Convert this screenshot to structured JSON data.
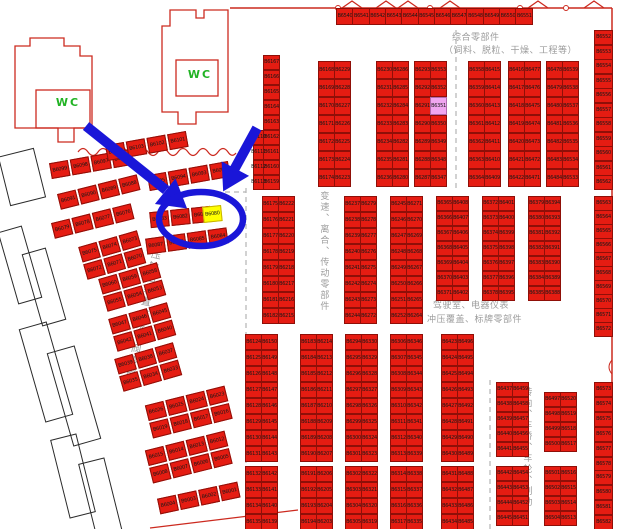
{
  "map": {
    "wc1": "WC",
    "wc2": "WC",
    "zones": {
      "comprehensive_line1": "综合零部件",
      "comprehensive_line2": "（饲料、脱粒、干燥、工程等）",
      "transmission": "变速、离合、传动零部件",
      "cab_line1": "驾驶室、电器仪表",
      "cab_line2": "冲压覆盖、标牌零部件",
      "steering": "转向、车桥、车轮、制动",
      "hydraulic": "液压输出装置、泵、阀零部件"
    },
    "highlight": {
      "selected_cell": "B6080",
      "selected_color": "#ffff00",
      "secondary_cell": "B6351",
      "secondary_color": "#f0a6f0"
    },
    "colors": {
      "cell_red": "#e51c12",
      "wall_red": "#cc2a1f",
      "annotation_blue": "#1a16d8",
      "wc_green": "#21b324",
      "zone_gray": "#9c9c9c"
    },
    "top_row": {
      "x": 336,
      "y": 8,
      "cw": 16,
      "ch": 15,
      "pitch": 16.3,
      "cells": [
        "B6540",
        "B6541",
        "B6542",
        "B6543",
        "B6544",
        "B6545",
        "B6546",
        "B6547",
        "B6548",
        "B6549",
        "B6550",
        "B6551"
      ]
    },
    "racks": [
      {
        "x": 263,
        "y": 55,
        "pitch": 15,
        "cw": 15,
        "ch": 13,
        "cols": [
          [
            "B6167",
            "B6166",
            "B6165",
            "B6164",
            "B6163",
            "B6162",
            "B6161",
            "B6160",
            "B6159"
          ]
        ]
      },
      {
        "x": 253,
        "y": 130,
        "pitch": 15,
        "cw": 9,
        "ch": 13,
        "cols": [
          [
            "B6110",
            "B6111",
            "B6112",
            "B6113"
          ]
        ]
      },
      {
        "x": 318,
        "y": 61,
        "pitch": 18,
        "cw": 15,
        "ch": 16,
        "cols": [
          [
            "B6168",
            "B6169",
            "B6170",
            "B6171",
            "B6172",
            "B6173",
            "B6174"
          ],
          [
            "B6229",
            "B6228",
            "B6227",
            "B6226",
            "B6225",
            "B6224",
            "B6223"
          ]
        ]
      },
      {
        "x": 376,
        "y": 61,
        "pitch": 18,
        "cw": 15,
        "ch": 16,
        "cols": [
          [
            "B6230",
            "B6231",
            "B6232",
            "B6233",
            "B6234",
            "B6235",
            "B6236"
          ],
          [
            "B6286",
            "B6285",
            "B6284",
            "B6283",
            "B6282",
            "B6281",
            "B6280"
          ]
        ]
      },
      {
        "x": 414,
        "y": 61,
        "pitch": 18,
        "cw": 15,
        "ch": 16,
        "cols": [
          [
            "B6293",
            "B6292",
            "B6291",
            "B6290",
            "B6289",
            "B6288",
            "B6287"
          ],
          [
            "B6353",
            "B6352",
            "B6351",
            "B6350",
            "B6349",
            "B6348",
            "B6347"
          ]
        ]
      },
      {
        "x": 468,
        "y": 61,
        "pitch": 18,
        "cw": 15,
        "ch": 16,
        "cols": [
          [
            "B6358",
            "B6359",
            "B6360",
            "B6361",
            "B6362",
            "B6363",
            "B6364"
          ],
          [
            "B6415",
            "B6414",
            "B6413",
            "B6412",
            "B6411",
            "B6410",
            "B6409"
          ]
        ]
      },
      {
        "x": 508,
        "y": 61,
        "pitch": 18,
        "cw": 15,
        "ch": 16,
        "cols": [
          [
            "B6416",
            "B6417",
            "B6418",
            "B6419",
            "B6420",
            "B6421",
            "B6422"
          ],
          [
            "B6477",
            "B6476",
            "B6475",
            "B6474",
            "B6473",
            "B6472",
            "B6471"
          ]
        ]
      },
      {
        "x": 546,
        "y": 61,
        "pitch": 18,
        "cw": 15,
        "ch": 16,
        "cols": [
          [
            "B6478",
            "B6479",
            "B6480",
            "B6481",
            "B6482",
            "B6483",
            "B6484"
          ],
          [
            "B6539",
            "B6538",
            "B6537",
            "B6536",
            "B6535",
            "B6534",
            "B6533"
          ]
        ]
      },
      {
        "x": 594,
        "y": 30,
        "pitch": 14.5,
        "cw": 17,
        "ch": 13,
        "cols": [
          [
            "B6552",
            "B6553",
            "B6554",
            "B6555",
            "B6556",
            "B6557",
            "B6558",
            "B6559",
            "B6560",
            "B6561",
            "B6562"
          ]
        ]
      },
      {
        "x": 262,
        "y": 196,
        "pitch": 16,
        "cw": 15,
        "ch": 14,
        "cols": [
          [
            "B6175",
            "B6176",
            "B6177",
            "B6178",
            "B6179",
            "B6180",
            "B6181",
            "B6182"
          ],
          [
            "B6222",
            "B6221",
            "B6220",
            "B6219",
            "B6218",
            "B6217",
            "B6216",
            "B6215"
          ]
        ]
      },
      {
        "x": 344,
        "y": 196,
        "pitch": 16,
        "cw": 15,
        "ch": 14,
        "cols": [
          [
            "B6237",
            "B6238",
            "B6239",
            "B6240",
            "B6241",
            "B6242",
            "B6243",
            "B6244"
          ],
          [
            "B6279",
            "B6278",
            "B6277",
            "B6276",
            "B6275",
            "B6274",
            "B6273",
            "B6272"
          ]
        ]
      },
      {
        "x": 390,
        "y": 196,
        "pitch": 16,
        "cw": 15,
        "ch": 14,
        "cols": [
          [
            "B6245",
            "B6246",
            "B6247",
            "B6248",
            "B6249",
            "B6250",
            "B6251",
            "B6252"
          ],
          [
            "B6271",
            "B6270",
            "B6269",
            "B6268",
            "B6267",
            "B6266",
            "B6265",
            "B6264"
          ]
        ]
      },
      {
        "x": 436,
        "y": 196,
        "pitch": 15,
        "cw": 15,
        "ch": 13,
        "cols": [
          [
            "B6365",
            "B6366",
            "B6367",
            "B6368",
            "B6369",
            "B6370",
            "B6371"
          ],
          [
            "B6408",
            "B6407",
            "B6406",
            "B6405",
            "B6404",
            "B6403",
            "B6402"
          ]
        ]
      },
      {
        "x": 482,
        "y": 196,
        "pitch": 15,
        "cw": 15,
        "ch": 13,
        "cols": [
          [
            "B6372",
            "B6373",
            "B6374",
            "B6375",
            "B6376",
            "B6377",
            "B6378"
          ],
          [
            "B6401",
            "B6400",
            "B6399",
            "B6398",
            "B6397",
            "B6396",
            "B6395"
          ]
        ]
      },
      {
        "x": 528,
        "y": 196,
        "pitch": 15,
        "cw": 15,
        "ch": 13,
        "cols": [
          [
            "B6379",
            "B6380",
            "B6381",
            "B6382",
            "B6383",
            "B6384",
            "B6385"
          ],
          [
            "B6394",
            "B6393",
            "B6392",
            "B6391",
            "B6390",
            "B6389",
            "B6388"
          ]
        ]
      },
      {
        "x": 594,
        "y": 196,
        "pitch": 14,
        "cw": 17,
        "ch": 13,
        "cols": [
          [
            "B6563",
            "B6564",
            "B6565",
            "B6566",
            "B6567",
            "B6568",
            "B6569",
            "B6570",
            "B6571",
            "B6572"
          ]
        ]
      },
      {
        "x": 245,
        "y": 334,
        "pitch": 16,
        "cw": 15,
        "ch": 14,
        "cols": [
          [
            "B6124",
            "B6125",
            "B6126",
            "B6127",
            "B6128",
            "B6129",
            "B6130",
            "B6131"
          ],
          [
            "B6150",
            "B6149",
            "B6148",
            "B6147",
            "B6146",
            "B6145",
            "B6144",
            "B6143"
          ]
        ]
      },
      {
        "x": 245,
        "y": 466,
        "pitch": 16,
        "cw": 15,
        "ch": 14,
        "cols": [
          [
            "B6132",
            "B6133",
            "B6134",
            "B6135"
          ],
          [
            "B6142",
            "B6141",
            "B6140",
            "B6139"
          ]
        ]
      },
      {
        "x": 300,
        "y": 334,
        "pitch": 16,
        "cw": 15,
        "ch": 14,
        "cols": [
          [
            "B6183",
            "B6184",
            "B6185",
            "B6186",
            "B6187",
            "B6188",
            "B6189",
            "B6190"
          ],
          [
            "B6214",
            "B6213",
            "B6212",
            "B6211",
            "B6210",
            "B6209",
            "B6208",
            "B6207"
          ]
        ]
      },
      {
        "x": 300,
        "y": 466,
        "pitch": 16,
        "cw": 15,
        "ch": 14,
        "cols": [
          [
            "B6191",
            "B6192",
            "B6193",
            "B6194"
          ],
          [
            "B6206",
            "B6205",
            "B6204",
            "B6203"
          ]
        ]
      },
      {
        "x": 345,
        "y": 334,
        "pitch": 16,
        "cw": 15,
        "ch": 14,
        "cols": [
          [
            "B6294",
            "B6295",
            "B6296",
            "B6297",
            "B6298",
            "B6299",
            "B6300",
            "B6301"
          ],
          [
            "B6330",
            "B6329",
            "B6328",
            "B6327",
            "B6326",
            "B6325",
            "B6324",
            "B6323"
          ]
        ]
      },
      {
        "x": 345,
        "y": 466,
        "pitch": 16,
        "cw": 15,
        "ch": 14,
        "cols": [
          [
            "B6302",
            "B6303",
            "B6304",
            "B6305"
          ],
          [
            "B6322",
            "B6321",
            "B6320",
            "B6319"
          ]
        ]
      },
      {
        "x": 390,
        "y": 334,
        "pitch": 16,
        "cw": 15,
        "ch": 14,
        "cols": [
          [
            "B6306",
            "B6307",
            "B6308",
            "B6309",
            "B6310",
            "B6311",
            "B6312",
            "B6313"
          ],
          [
            "B6346",
            "B6345",
            "B6344",
            "B6343",
            "B6342",
            "B6341",
            "B6340",
            "B6339"
          ]
        ]
      },
      {
        "x": 390,
        "y": 466,
        "pitch": 16,
        "cw": 15,
        "ch": 14,
        "cols": [
          [
            "B6314",
            "B6315",
            "B6316",
            "B6317"
          ],
          [
            "B6338",
            "B6337",
            "B6336",
            "B6335"
          ]
        ]
      },
      {
        "x": 441,
        "y": 334,
        "pitch": 16,
        "cw": 15,
        "ch": 14,
        "cols": [
          [
            "B6423",
            "B6424",
            "B6425",
            "B6426",
            "B6427",
            "B6428",
            "B6429",
            "B6430"
          ],
          [
            "B6496",
            "B6495",
            "B6494",
            "B6493",
            "B6492",
            "B6491",
            "B6490",
            "B6489"
          ]
        ]
      },
      {
        "x": 441,
        "y": 466,
        "pitch": 16,
        "cw": 15,
        "ch": 14,
        "cols": [
          [
            "B6431",
            "B6432",
            "B6433",
            "B6434"
          ],
          [
            "B6488",
            "B6487",
            "B6486",
            "B6485"
          ]
        ]
      },
      {
        "x": 496,
        "y": 382,
        "pitch": 15,
        "cw": 15,
        "ch": 13,
        "cols": [
          [
            "B6437",
            "B6438",
            "B6439",
            "B6440",
            "B6441"
          ],
          [
            "B6459",
            "B6458",
            "B6457",
            "B6456",
            "B6455"
          ]
        ]
      },
      {
        "x": 496,
        "y": 466,
        "pitch": 15,
        "cw": 15,
        "ch": 13,
        "cols": [
          [
            "B6442",
            "B6443",
            "B6444",
            "B6445"
          ],
          [
            "B6454",
            "B6453",
            "B6452",
            "B6451"
          ]
        ]
      },
      {
        "x": 544,
        "y": 392,
        "pitch": 15,
        "cw": 15,
        "ch": 13,
        "cols": [
          [
            "B6497",
            "B6498",
            "B6499",
            "B6500"
          ],
          [
            "B6520",
            "B6519",
            "B6518",
            "B6517"
          ]
        ]
      },
      {
        "x": 544,
        "y": 466,
        "pitch": 15,
        "cw": 15,
        "ch": 13,
        "cols": [
          [
            "B6501",
            "B6502",
            "B6503",
            "B6504"
          ],
          [
            "B6516",
            "B6515",
            "B6514",
            "B6513"
          ]
        ]
      },
      {
        "x": 594,
        "y": 382,
        "pitch": 15,
        "cw": 17,
        "ch": 13,
        "cols": [
          [
            "B6573",
            "B6574",
            "B6575",
            "B6576",
            "B6577",
            "B6578"
          ]
        ]
      },
      {
        "x": 594,
        "y": 470,
        "pitch": 15,
        "cw": 17,
        "ch": 13,
        "cols": [
          [
            "B6579",
            "B6580",
            "B6581",
            "B6582"
          ]
        ]
      }
    ],
    "clusters": [
      {
        "x": 50,
        "y": 156,
        "rot": -10,
        "rows": [
          [
            "B6099",
            "B6098",
            "B6097",
            "B6096"
          ]
        ]
      },
      {
        "x": 106,
        "y": 138,
        "rot": -10,
        "rows": [
          [
            "B6104",
            "B6103",
            "B6102",
            "B6101"
          ]
        ]
      },
      {
        "x": 148,
        "y": 168,
        "rot": -10,
        "rows": [
          [
            "B6095",
            "B6094",
            "B6093",
            "B6092"
          ]
        ]
      },
      {
        "x": 58,
        "y": 184,
        "rot": -14,
        "rows": [
          [
            "B6091",
            "B6090",
            "B6089",
            "B6088"
          ]
        ]
      },
      {
        "x": 150,
        "y": 209,
        "rot": -6,
        "rows": [
          [
            "B6083",
            "B6082",
            "B6081"
          ]
        ]
      },
      {
        "x": 203,
        "y": 206,
        "rot": -6,
        "rows": [
          [
            "B6080"
          ]
        ]
      },
      {
        "x": 146,
        "y": 233,
        "rot": -8,
        "rows": [
          [
            "B6087",
            "B6086",
            "B6085",
            "B6084"
          ]
        ]
      },
      {
        "x": 52,
        "y": 213,
        "rot": -14,
        "rows": [
          [
            "B6079",
            "B6078",
            "B6077",
            "B6076"
          ]
        ]
      },
      {
        "x": 82,
        "y": 238,
        "rot": -16,
        "rows": [
          [
            "B6075",
            "B6074",
            "B6073"
          ],
          [
            "B6072",
            "B6071",
            "B6070"
          ]
        ]
      },
      {
        "x": 102,
        "y": 270,
        "rot": -16,
        "rows": [
          [
            "B6060",
            "B6059",
            "B6058"
          ],
          [
            "B6055",
            "B6054",
            "B6053"
          ]
        ]
      },
      {
        "x": 112,
        "y": 310,
        "rot": -16,
        "rows": [
          [
            "B6047",
            "B6046",
            "B6045"
          ],
          [
            "B6042",
            "B6041",
            "B6040"
          ]
        ]
      },
      {
        "x": 118,
        "y": 350,
        "rot": -16,
        "rows": [
          [
            "B6039",
            "B6038",
            "B6037"
          ],
          [
            "B6035",
            "B6034",
            "B6033"
          ]
        ]
      },
      {
        "x": 148,
        "y": 395,
        "rot": -14,
        "rows": [
          [
            "B6026",
            "B6025",
            "B6024",
            "B6023"
          ],
          [
            "B6019",
            "B6018",
            "B6017",
            "B6016"
          ]
        ]
      },
      {
        "x": 148,
        "y": 440,
        "rot": -14,
        "rows": [
          [
            "B6015",
            "B6014",
            "B6013",
            "B6012"
          ],
          [
            "B6008",
            "B6007",
            "B6006",
            "B6005"
          ]
        ]
      },
      {
        "x": 158,
        "y": 490,
        "rot": -12,
        "rows": [
          [
            "B6004",
            "B6003",
            "B6002",
            "B6001"
          ]
        ]
      }
    ]
  }
}
